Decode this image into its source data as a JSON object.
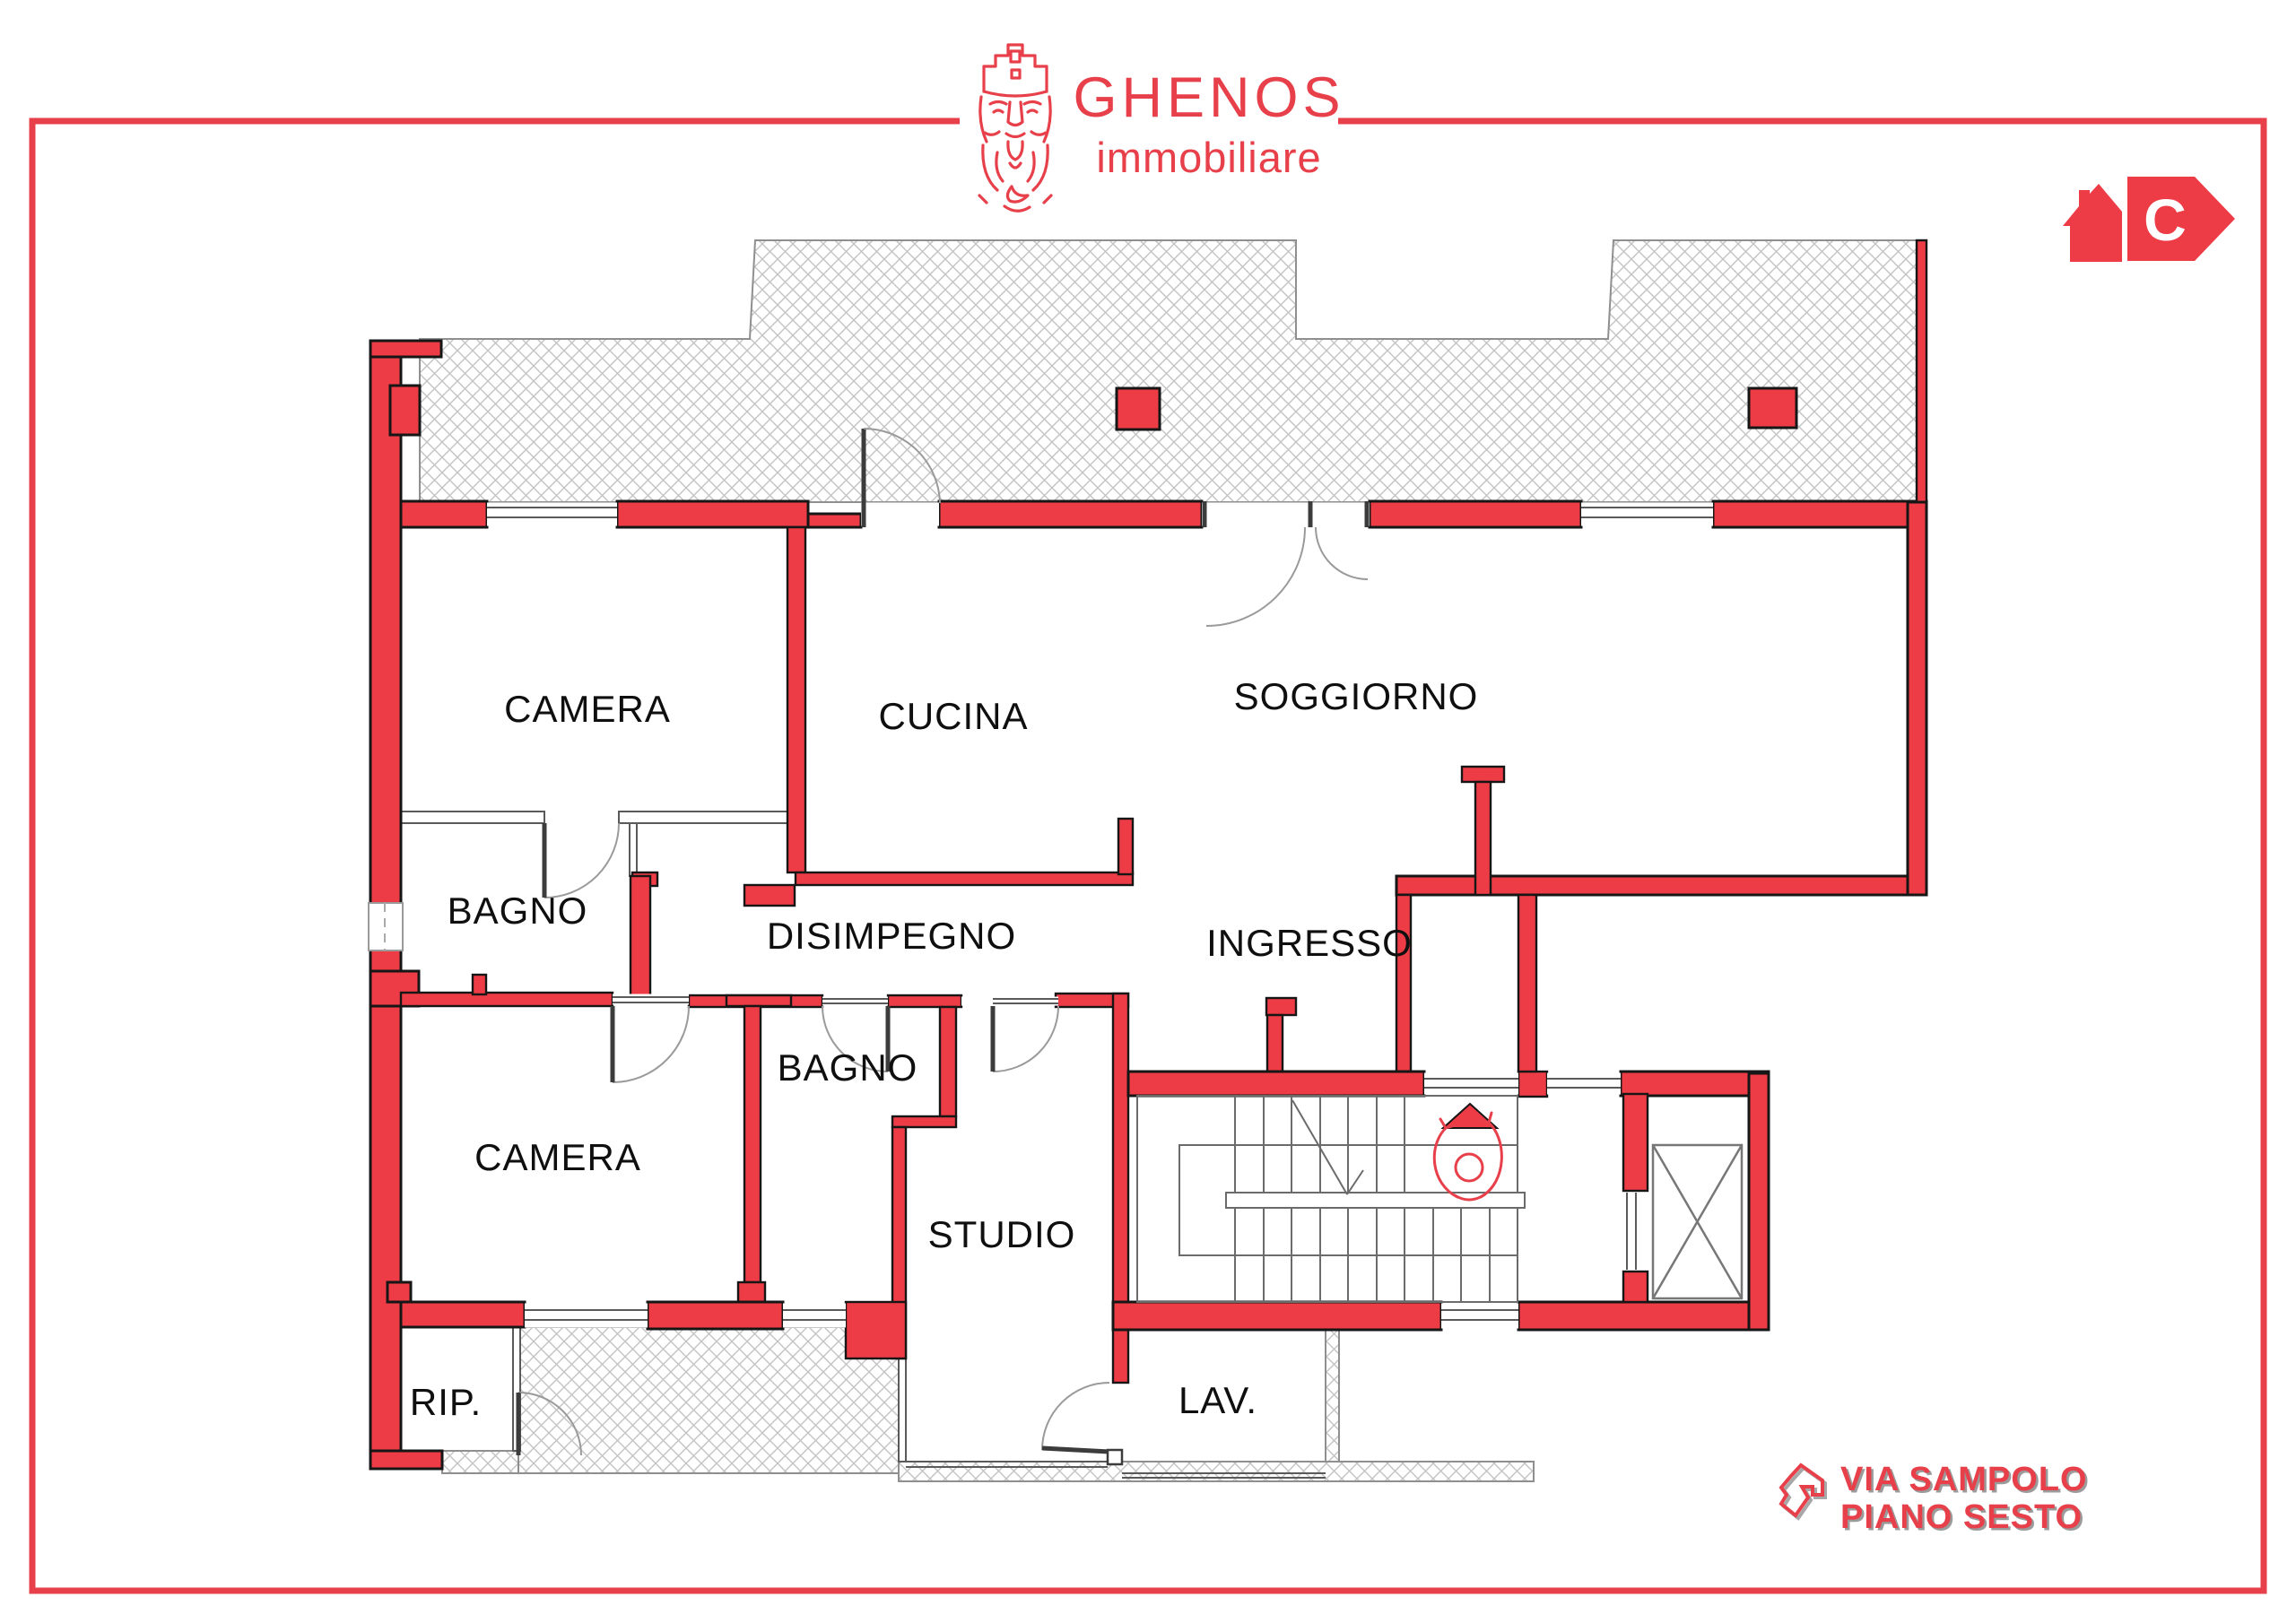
{
  "header": {
    "brand_name": "GHENOS",
    "brand_tagline": "immobiliare"
  },
  "energy_badge": {
    "class_letter": "C"
  },
  "floorplan": {
    "rooms": [
      {
        "id": "camera-1",
        "label": "CAMERA"
      },
      {
        "id": "cucina",
        "label": "CUCINA"
      },
      {
        "id": "soggiorno",
        "label": "SOGGIORNO"
      },
      {
        "id": "bagno-1",
        "label": "BAGNO"
      },
      {
        "id": "disimpegno",
        "label": "DISIMPEGNO"
      },
      {
        "id": "ingresso",
        "label": "INGRESSO"
      },
      {
        "id": "bagno-2",
        "label": "BAGNO"
      },
      {
        "id": "camera-2",
        "label": "CAMERA"
      },
      {
        "id": "studio",
        "label": "STUDIO"
      },
      {
        "id": "ripostiglio",
        "label": "RIP."
      },
      {
        "id": "lavanderia",
        "label": "LAV."
      }
    ]
  },
  "footer": {
    "address_line1": "VIA SAMPOLO",
    "address_line2": "PIANO SESTO"
  },
  "colors": {
    "accent-red": "#e8404a",
    "wall-red": "#ee3c46",
    "line-dark": "#161616",
    "thin-line": "#5a5a5a",
    "hatch-edge": "#8f8f8f",
    "hatch-gray": "#c3c3c3"
  }
}
